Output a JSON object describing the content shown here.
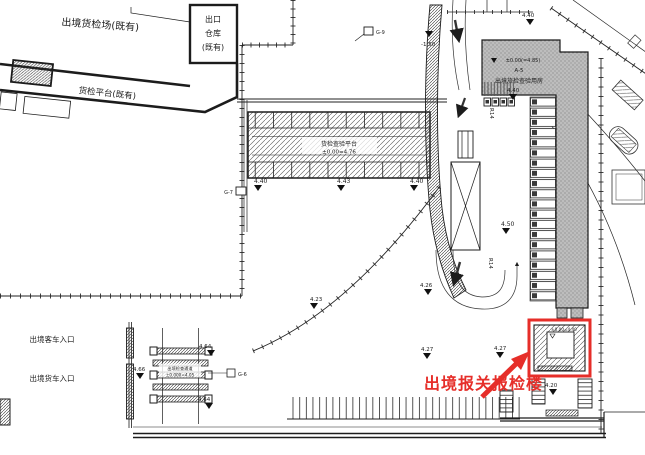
{
  "drawing": {
    "title_note": "site plan",
    "colors": {
      "highlight": "#e62e29",
      "line": "#1c1c1c",
      "building_fill": "#b5b5b5"
    },
    "existing": {
      "field_label": "出境货检场(既有)",
      "warehouse_l1": "出口",
      "warehouse_l2": "仓库",
      "warehouse_l3": "(既有)",
      "platform_label": "货检平台(既有)"
    },
    "entrances": {
      "bus": "出境客车入口",
      "truck": "出境货车入口"
    },
    "platform_building": {
      "name": "货检查验平台",
      "level": "±0.00=4.76"
    },
    "main_building": {
      "floor": "1F",
      "level": "±0.00(=4.85)",
      "code": "A-5",
      "name": "出境旅检查验用房"
    },
    "toll_gate": {
      "name": "出境检查通道",
      "level": "±0.000=4.05",
      "note": "G-6"
    },
    "highlight": {
      "label": "出境报关报检楼",
      "inner_level": "±0.00=4.40"
    },
    "keynotes": {
      "g9": "G-9",
      "g7": "G-7"
    },
    "radius": [
      "R14",
      "R14"
    ],
    "elevations": [
      {
        "v": "4.40"
      },
      {
        "v": "-1.50"
      },
      {
        "v": "4.40"
      },
      {
        "v": "4.40"
      },
      {
        "v": "4.43"
      },
      {
        "v": "4.40"
      },
      {
        "v": "4.50"
      },
      {
        "v": "4.23"
      },
      {
        "v": "4.26"
      },
      {
        "v": "4.64"
      },
      {
        "v": "4.66"
      },
      {
        "v": "4.64"
      },
      {
        "v": "4.27"
      },
      {
        "v": "4.27"
      },
      {
        "v": "4.20"
      }
    ]
  }
}
